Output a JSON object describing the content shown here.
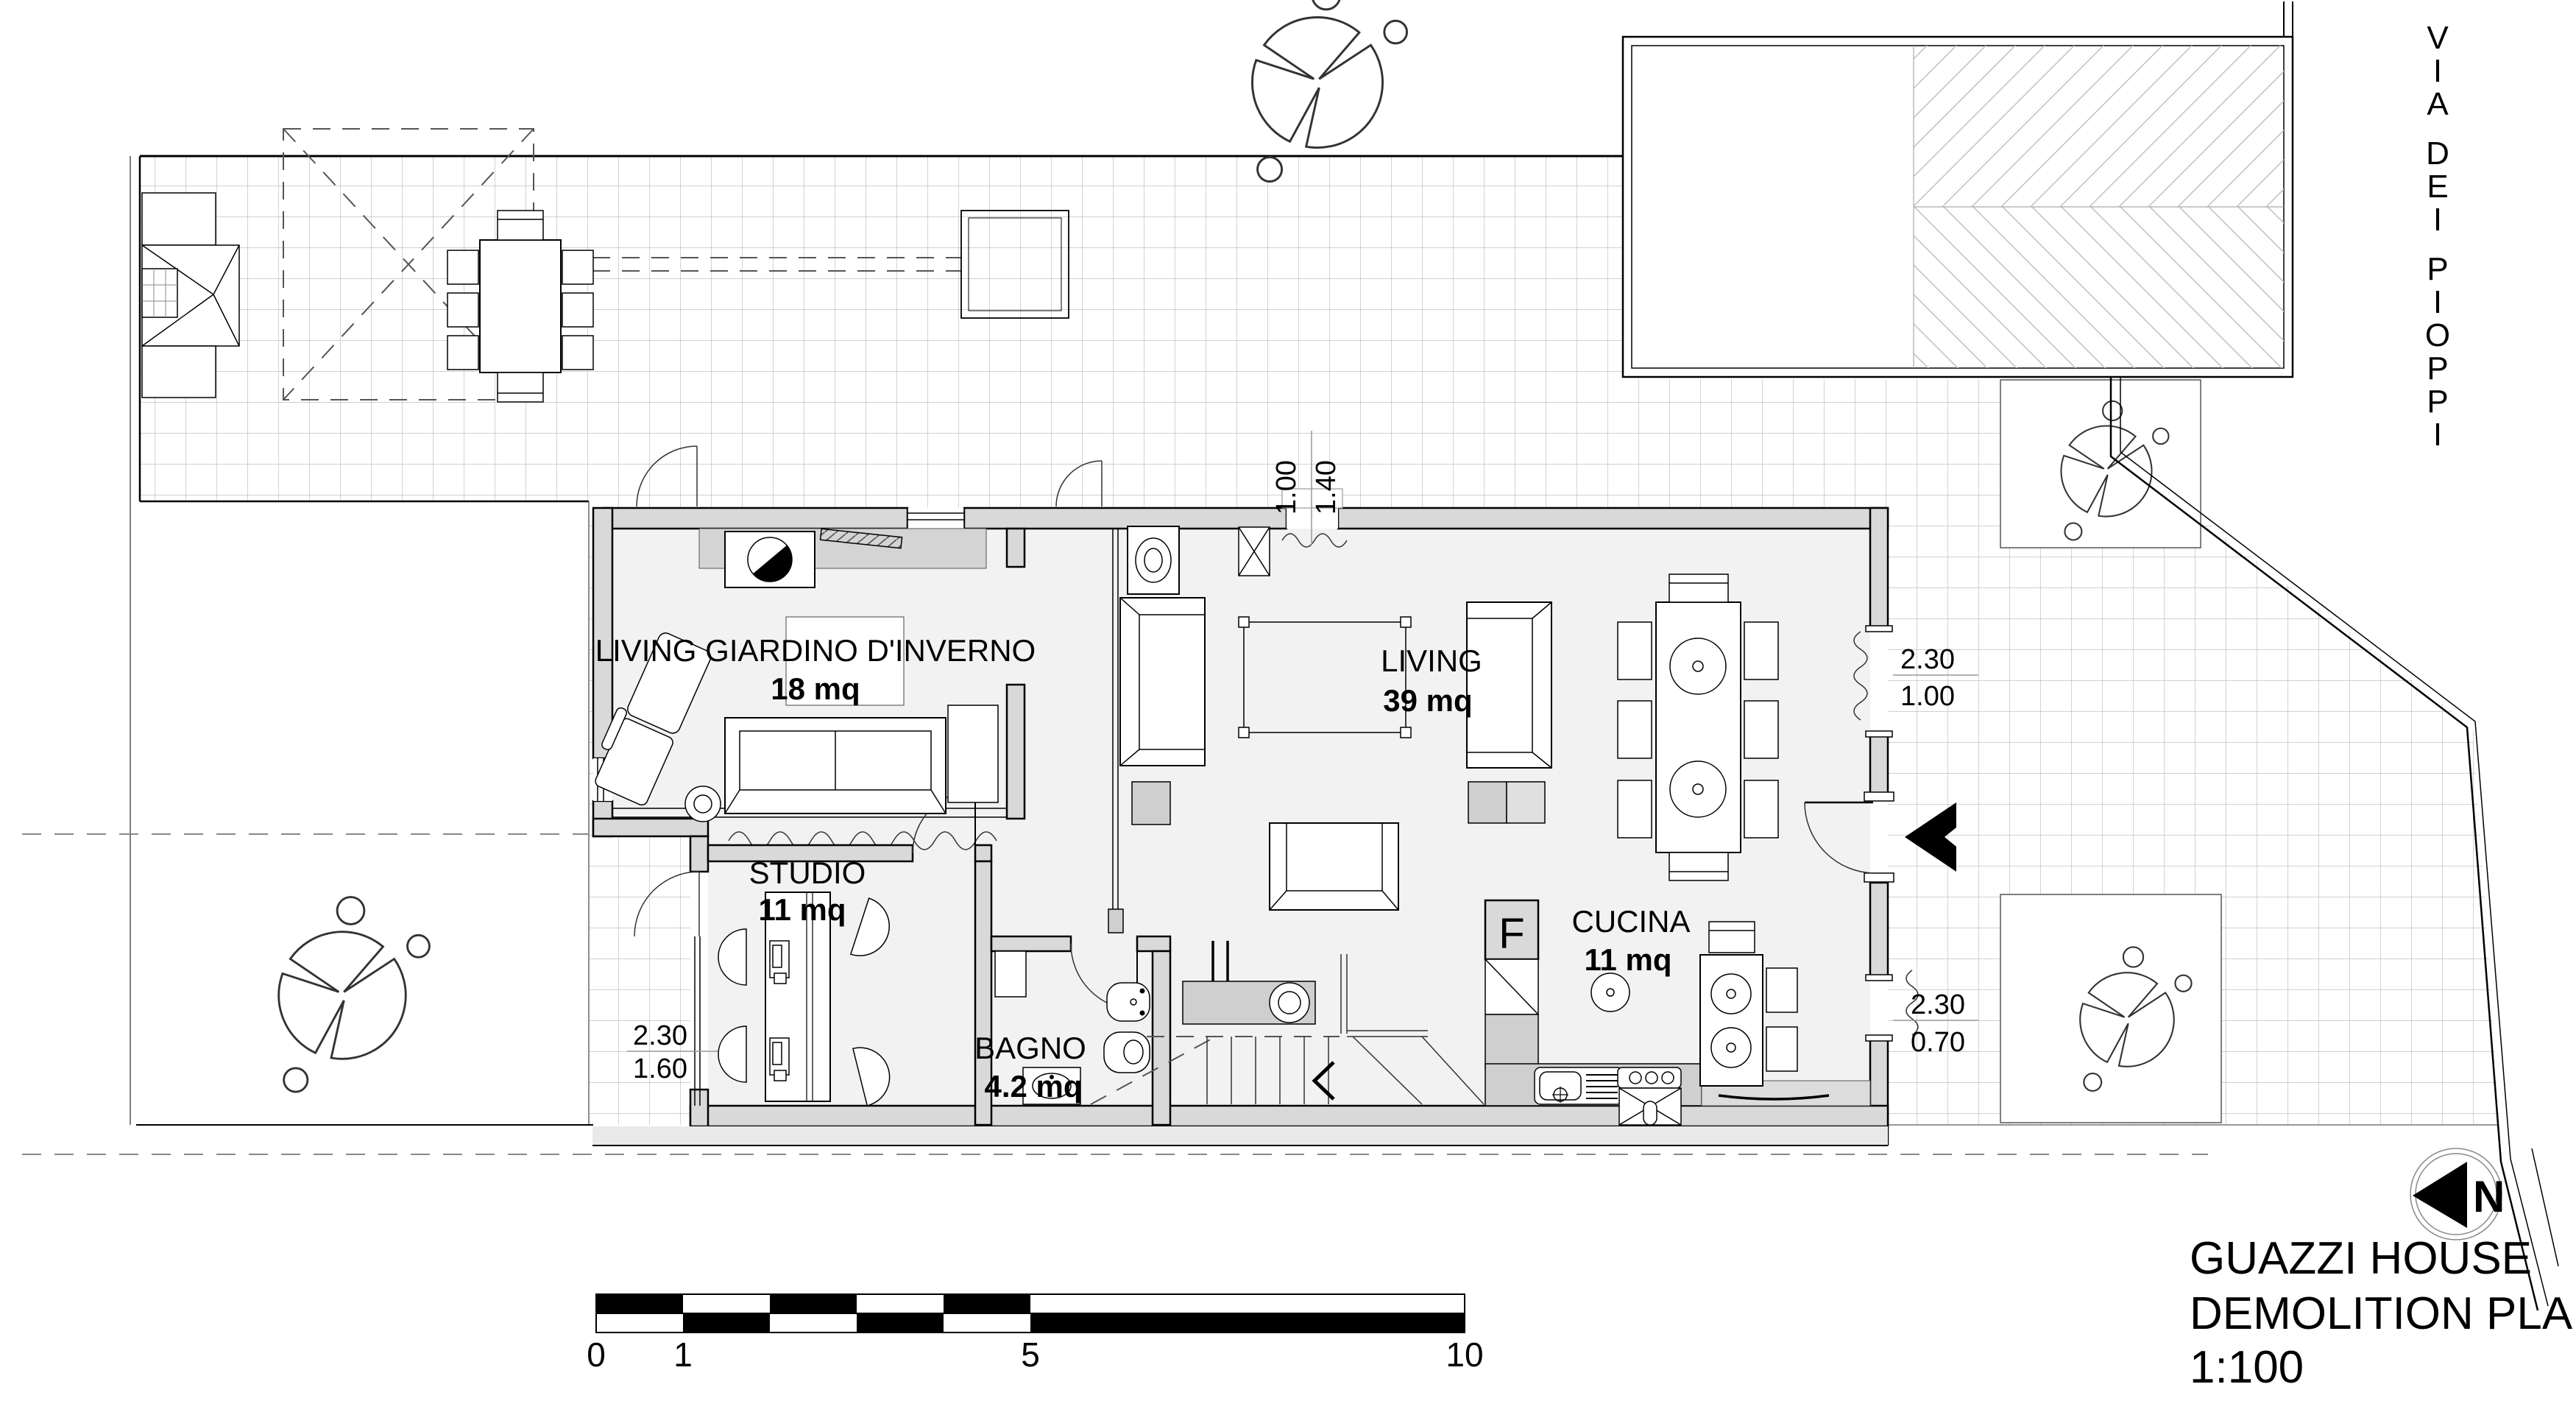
{
  "colors": {
    "paper": "#ffffff",
    "wall_fill": "#d9d9d9",
    "tile_line": "#b5b5b5",
    "hatch_line": "#c4c4c4",
    "counter_fill": "#cfcfcf",
    "ink": "#000000"
  },
  "rooms": [
    {
      "name": "LIVING GIARDINO D'INVERNO",
      "area": "18 mq"
    },
    {
      "name": "LIVING",
      "area": "39 mq"
    },
    {
      "name": "STUDIO",
      "area": "11 mq"
    },
    {
      "name": "BAGNO",
      "area": "4.2 mq"
    },
    {
      "name": "CUCINA",
      "area": "11 mq"
    }
  ],
  "labels": {
    "fridge": "F"
  },
  "dimensions": {
    "north_window": {
      "a": "1.00",
      "b": "1.40"
    },
    "east_upper_window": {
      "a": "2.30",
      "b": "1.00"
    },
    "east_lower_window": {
      "a": "2.30",
      "b": "0.70"
    },
    "west_window": {
      "a": "2.30",
      "b": "1.60"
    }
  },
  "street": {
    "name": "VIA DEI PIOPPI"
  },
  "north_arrow": {
    "label": "N"
  },
  "scale_bar": {
    "labels": [
      "0",
      "1",
      "5",
      "10"
    ]
  },
  "title_block": {
    "project": "GUAZZI HOUSE",
    "drawing": "DEMOLITION PLAN",
    "scale": "1:100"
  }
}
